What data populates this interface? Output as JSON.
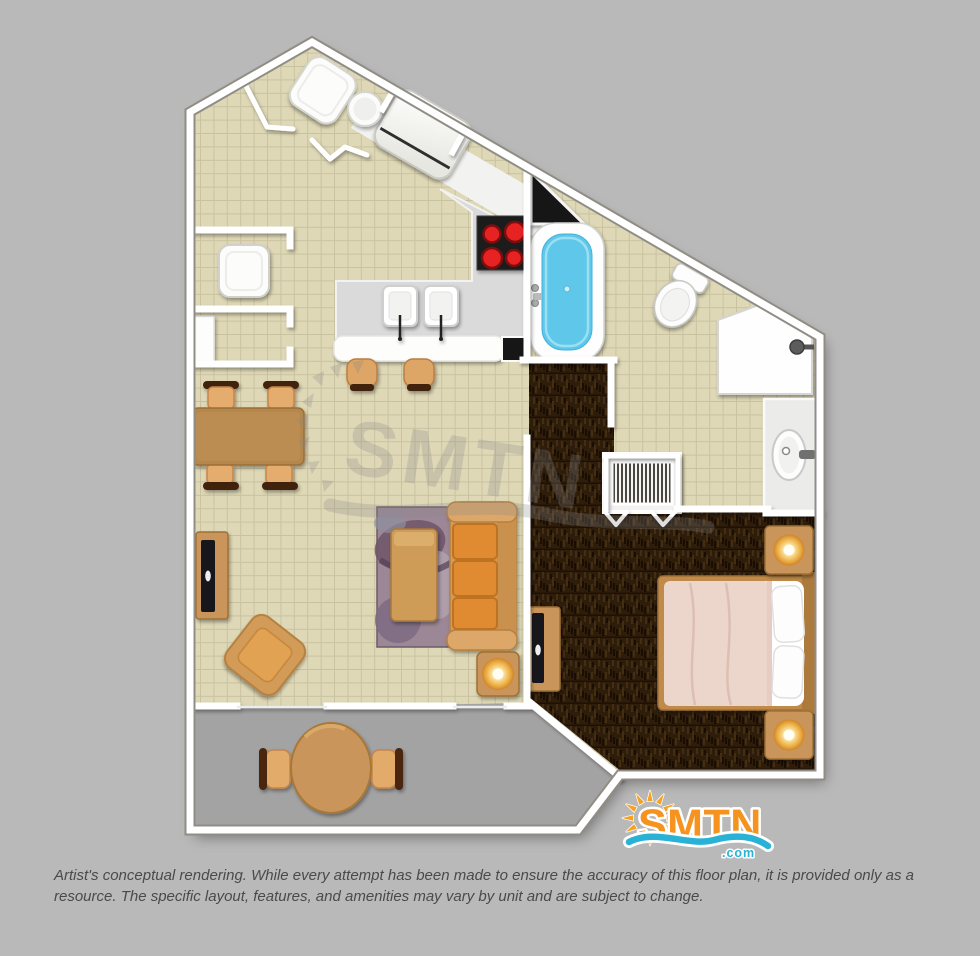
{
  "branding": {
    "logo_text": "SMTN",
    "logo_tld": ".com"
  },
  "watermark": {
    "text": "SMTN"
  },
  "disclaimer": {
    "text": "Artist's conceptual rendering. While every attempt has been made to ensure the accuracy of this floor plan, it is provided only as a resource. The specific layout, features, and amenities may vary by unit and are subject to change."
  },
  "palette": {
    "background": "#b9b9b9",
    "wall_white": "#ffffff",
    "wall_casing": "#8f8d84",
    "tile_floor": "#ded8b6",
    "tile_grid": "#c9c2a0",
    "bedroom_carpet": "#2f1d0c",
    "balcony_floor": "#a3a3a3",
    "counter_gray": "#dadada",
    "appliance_white": "#fbfbfb",
    "stove_black": "#1c1c1c",
    "burner_red": "#e62222",
    "tub_water": "#5fc7e9",
    "wood_tan": "#c9955a",
    "chair_dark": "#3f2410",
    "sofa_orange": "#e08a33",
    "rug_mauve": "#9c8796",
    "bedding_pink": "#ecd5ca",
    "lamp_glow": "#fbdf96",
    "logo_orange": "#f6921e",
    "logo_blue": "#29b2d6",
    "disclaimer_text": "#4a4a4a"
  }
}
